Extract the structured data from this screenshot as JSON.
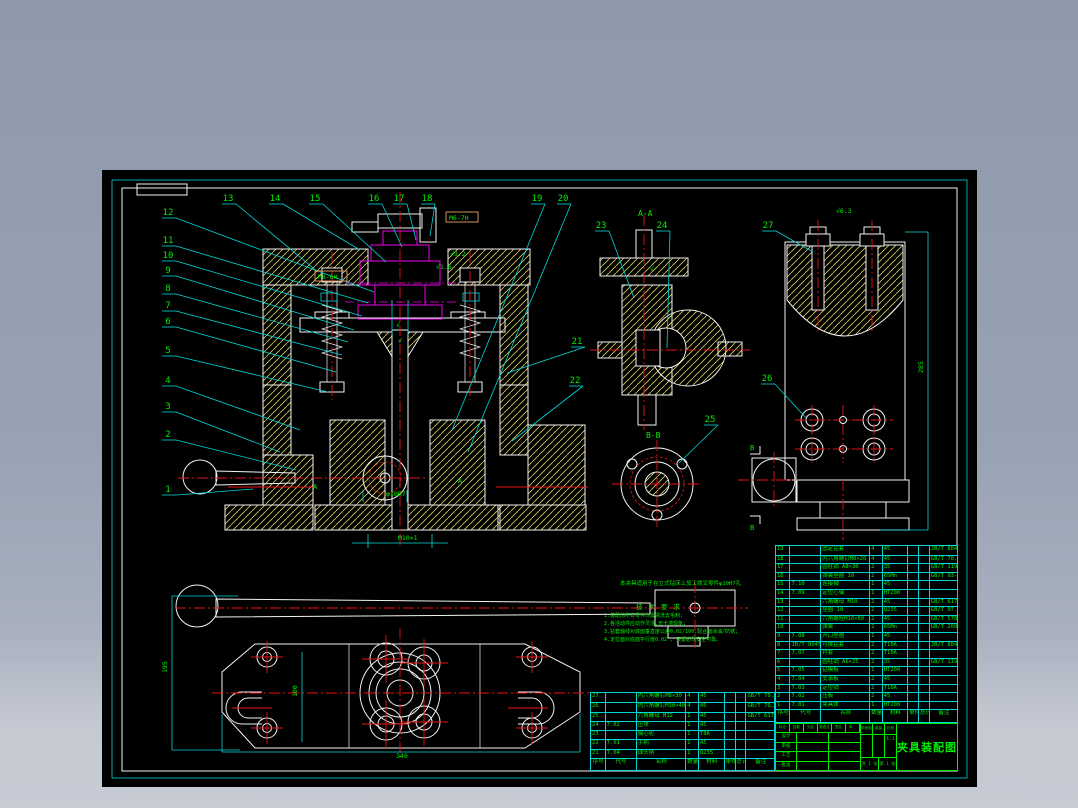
{
  "drawing": {
    "type": "CAD assembly drawing",
    "bg_canvas": "#000000",
    "frame_color": "#00d8d8",
    "border_color": "#f2f2f2",
    "hatch_color": "#d8d25e",
    "centerline_color": "#e81212",
    "leader_color": "#00d8d8",
    "text_color": "#00ee00",
    "workpiece_color": "#ee00ee"
  },
  "views": {
    "aa": "A-A",
    "bb": "B-B",
    "a_marker": "A",
    "b_marker": "B"
  },
  "callouts": [
    {
      "n": "1",
      "x": 168,
      "y": 492,
      "ex": 253,
      "ey": 489
    },
    {
      "n": "2",
      "x": 168,
      "y": 437,
      "ex": 296,
      "ey": 470
    },
    {
      "n": "3",
      "x": 168,
      "y": 409,
      "ex": 280,
      "ey": 452
    },
    {
      "n": "4",
      "x": 168,
      "y": 383,
      "ex": 300,
      "ey": 430
    },
    {
      "n": "5",
      "x": 168,
      "y": 353,
      "ex": 328,
      "ey": 392
    },
    {
      "n": "6",
      "x": 168,
      "y": 324,
      "ex": 336,
      "ey": 372
    },
    {
      "n": "7",
      "x": 168,
      "y": 308,
      "ex": 342,
      "ey": 355
    },
    {
      "n": "8",
      "x": 168,
      "y": 291,
      "ex": 348,
      "ey": 342
    },
    {
      "n": "9",
      "x": 168,
      "y": 273,
      "ex": 354,
      "ey": 330
    },
    {
      "n": "10",
      "x": 168,
      "y": 258,
      "ex": 362,
      "ey": 316
    },
    {
      "n": "11",
      "x": 168,
      "y": 243,
      "ex": 368,
      "ey": 303
    },
    {
      "n": "12",
      "x": 168,
      "y": 215,
      "ex": 374,
      "ey": 292
    },
    {
      "n": "13",
      "x": 228,
      "y": 201,
      "ex": 318,
      "ey": 272
    },
    {
      "n": "14",
      "x": 275,
      "y": 201,
      "ex": 360,
      "ey": 250
    },
    {
      "n": "15",
      "x": 315,
      "y": 201,
      "ex": 386,
      "ey": 262
    },
    {
      "n": "16",
      "x": 374,
      "y": 201,
      "ex": 402,
      "ey": 247
    },
    {
      "n": "17",
      "x": 399,
      "y": 201,
      "ex": 416,
      "ey": 240
    },
    {
      "n": "18",
      "x": 427,
      "y": 201,
      "ex": 430,
      "ey": 236
    },
    {
      "n": "19",
      "x": 537,
      "y": 201,
      "ex": 452,
      "ey": 430
    },
    {
      "n": "20",
      "x": 563,
      "y": 201,
      "ex": 468,
      "ey": 452
    },
    {
      "n": "21",
      "x": 577,
      "y": 344,
      "ex": 507,
      "ey": 373
    },
    {
      "n": "22",
      "x": 575,
      "y": 383,
      "ex": 512,
      "ey": 441
    },
    {
      "n": "23",
      "x": 601,
      "y": 228,
      "ex": 634,
      "ey": 298
    },
    {
      "n": "24",
      "x": 662,
      "y": 228,
      "ex": 667,
      "ey": 348
    },
    {
      "n": "25",
      "x": 710,
      "y": 422,
      "ex": 679,
      "ey": 463
    },
    {
      "n": "26",
      "x": 767,
      "y": 381,
      "ex": 806,
      "ey": 418
    },
    {
      "n": "27",
      "x": 768,
      "y": 228,
      "ex": 813,
      "ey": 252
    }
  ],
  "dims": [
    {
      "text": "M8-6H",
      "x": 318,
      "y": 279,
      "box": true
    },
    {
      "text": "M6-7H",
      "x": 449,
      "y": 220,
      "box": true
    },
    {
      "text": "M10×1",
      "x": 398,
      "y": 540
    },
    {
      "text": "φ10H7",
      "x": 386,
      "y": 496
    },
    {
      "text": "√3.2",
      "x": 450,
      "y": 256
    },
    {
      "text": "√1.6",
      "x": 436,
      "y": 269
    },
    {
      "text": "√",
      "x": 396,
      "y": 327
    },
    {
      "text": "√",
      "x": 398,
      "y": 343
    },
    {
      "text": "√",
      "x": 650,
      "y": 271
    },
    {
      "text": "√6.3",
      "x": 836,
      "y": 213
    },
    {
      "text": "285",
      "x": 923,
      "y": 373,
      "rot": true
    },
    {
      "text": "195",
      "x": 167,
      "y": 673,
      "rot": true
    },
    {
      "text": "100",
      "x": 297,
      "y": 697,
      "rot": true
    },
    {
      "text": "340",
      "x": 396,
      "y": 758
    }
  ],
  "notes": {
    "caption": "本夹具适用于在立式钻床上加工拨叉零件φ10H7孔",
    "title": "技 术 要 求",
    "items": [
      "1.装配前所有零件均需清洗去毛刺;",
      "2.各活动件应动作灵活,无卡滞现象;",
      "3.钻套轴线对底面垂直度公差0.02/100,配合面涂油/防锈;",
      "4.定位面对底面平行度0.02 , 夹紧必须安全可靠。"
    ]
  },
  "bom_right": {
    "col_widths": [
      8,
      17,
      27,
      7,
      14,
      6,
      6,
      15
    ],
    "headers": [
      "序号",
      "代号",
      "名称",
      "数量",
      "材料",
      "单件",
      "总计",
      "备注"
    ],
    "rows": [
      [
        "19",
        "",
        "固定钻套",
        "4",
        "45",
        "",
        "",
        "JB/T 8045.1-1999"
      ],
      [
        "18",
        "",
        "内六角螺钉M8×20",
        "4",
        "45",
        "",
        "",
        "GB/T 70.1-2000"
      ],
      [
        "17",
        "",
        "圆柱销 A8×30",
        "2",
        "35",
        "",
        "",
        "GB/T 119.1-2000"
      ],
      [
        "16",
        "",
        "弹簧垫圈 10",
        "2",
        "65Mn",
        "",
        "",
        "GB/T 93-1987"
      ],
      [
        "15",
        "7.10",
        "连接轴",
        "1",
        "45",
        "",
        "",
        ""
      ],
      [
        "14",
        "7.09",
        "定位心轴",
        "1",
        "HT200",
        "",
        "",
        ""
      ],
      [
        "13",
        "",
        "六角螺母 M10",
        "2",
        "45",
        "",
        "",
        "GB/T 6170-2000"
      ],
      [
        "12",
        "",
        "垫圈 10",
        "2",
        "Q235",
        "",
        "",
        "GB/T 97.1-2002"
      ],
      [
        "11",
        "",
        "六角螺栓M10×60",
        "2",
        "45",
        "",
        "",
        "GB/T 5782-2000"
      ],
      [
        "10",
        "",
        "弹簧",
        "2",
        "65Mn",
        "",
        "",
        "GB/T 2089-2009"
      ],
      [
        "9",
        "7.08",
        "开口垫圈",
        "1",
        "45",
        "",
        "",
        ""
      ],
      [
        "8",
        "JB/T 8045.2",
        "可换钻套",
        "2",
        "T10A",
        "",
        "",
        "JB/T 8045.2-1999"
      ],
      [
        "7",
        "7.07",
        "衬套",
        "2",
        "T10A",
        "",
        "",
        ""
      ],
      [
        "6",
        "",
        "圆柱销 A6×25",
        "2",
        "35",
        "",
        "",
        "GB/T 119.1-2000"
      ],
      [
        "5",
        "7.05",
        "钻模板",
        "1",
        "HT200",
        "",
        "",
        ""
      ],
      [
        "4",
        "7.04",
        "支承板",
        "2",
        "45",
        "",
        "",
        ""
      ],
      [
        "3",
        "7.03",
        "定位销",
        "2",
        "T10A",
        "",
        "",
        ""
      ],
      [
        "2",
        "7.02",
        "压板",
        "2",
        "45",
        "",
        "",
        ""
      ],
      [
        "1",
        "7.01",
        "夹具体",
        "1",
        "HT200",
        "",
        "",
        ""
      ]
    ]
  },
  "bom_left": {
    "col_widths": [
      8,
      17,
      27,
      7,
      14,
      6,
      6,
      15
    ],
    "headers": [
      "序号",
      "代号",
      "名称",
      "数量",
      "材料",
      "单件",
      "总计",
      "备注"
    ],
    "rows": [
      [
        "27",
        "",
        "内六角螺钉M8×30",
        "4",
        "45",
        "",
        "",
        "GB/T 70.1-2000"
      ],
      [
        "26",
        "",
        "内六角螺钉M10×40",
        "4",
        "45",
        "",
        "",
        "GB/T 70.1-2000"
      ],
      [
        "25",
        "",
        "六角螺母 M12",
        "1",
        "45",
        "",
        "",
        "GB/T 6170-2000"
      ],
      [
        "24",
        "7.02",
        "压块",
        "1",
        "45",
        "",
        "",
        ""
      ],
      [
        "23",
        "",
        "偏心轮",
        "1",
        "T8A",
        "",
        "",
        ""
      ],
      [
        "22",
        "7.01",
        "手柄",
        "1",
        "45",
        "",
        "",
        ""
      ],
      [
        "21",
        "7.04",
        "球头柄",
        "1",
        "Q235",
        "",
        "",
        ""
      ]
    ]
  },
  "title_block": {
    "title": "夹具装配图",
    "mark_row": [
      "标记",
      "处数",
      "分区",
      "更改文件号",
      "签名",
      "年、月、日"
    ],
    "left_fields": [
      "设计",
      "审核",
      "工艺",
      "批准"
    ],
    "stage_label": "阶段标记",
    "weight_label": "重量",
    "scale_label": "比例",
    "scale_value": "1:1",
    "sheet_total": "共 1 张",
    "sheet_no": "第 1 张"
  }
}
